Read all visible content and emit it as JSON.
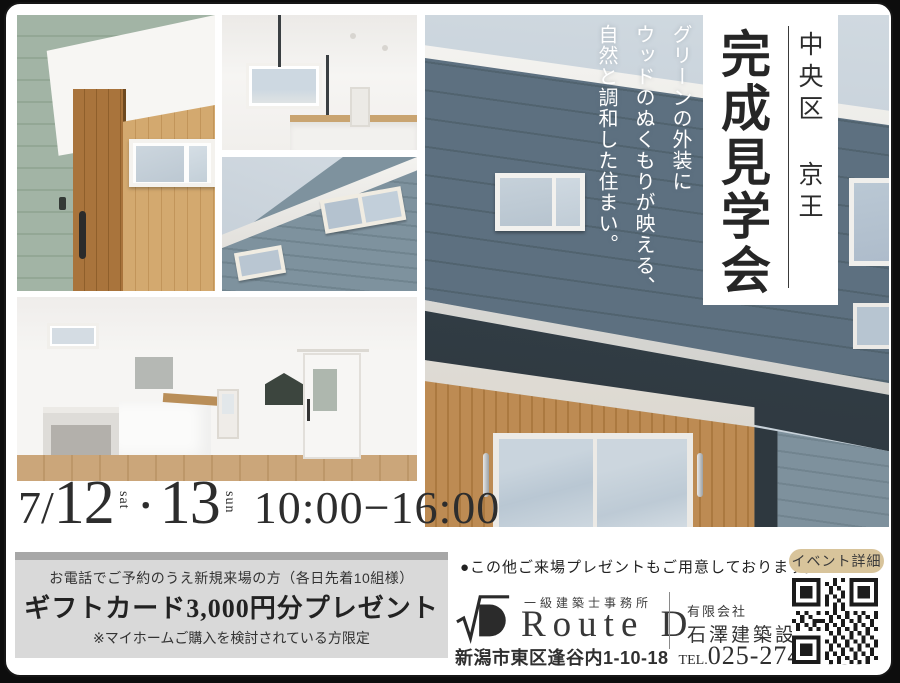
{
  "header": {
    "location": "中央区 京王",
    "title": "完成見学会",
    "tagline": "グリーンの外装に\nウッドのぬくもりが映える、\n自然と調和した住まい。"
  },
  "schedule": {
    "month": "7/",
    "day1": "12",
    "dow1": "sat",
    "sep": "・",
    "day2": "13",
    "dow2": "sun",
    "time": "10:00−16:00"
  },
  "offer": {
    "condition": "お電話でご予約のうえ新規来場の方（各日先着10組様）",
    "headline": "ギフトカード3,000円分プレゼント",
    "note": "※マイホームご購入を検討されている方限定"
  },
  "footer": {
    "bullet_note": "●この他ご来場プレゼントもご用意しております。",
    "office_type": "一級建築士事務所",
    "brand": "Route D",
    "company_prefix": "有限会社",
    "company": "石澤建築設計",
    "address": "新潟市東区逢谷内1-10-18",
    "tel_label": "TEL.",
    "tel": "025-274-4555",
    "qr_label": "イベント詳細"
  },
  "colors": {
    "ink": "#2d2d2d",
    "accent_tan": "#d8c49b",
    "offer_box_gray": "#d9d9d9",
    "offer_bar_gray": "#a7a7a7",
    "siding_green": "#9cb0a1",
    "siding_blue_gray": "#5d7080",
    "wood_cedar": "#b5824e"
  }
}
